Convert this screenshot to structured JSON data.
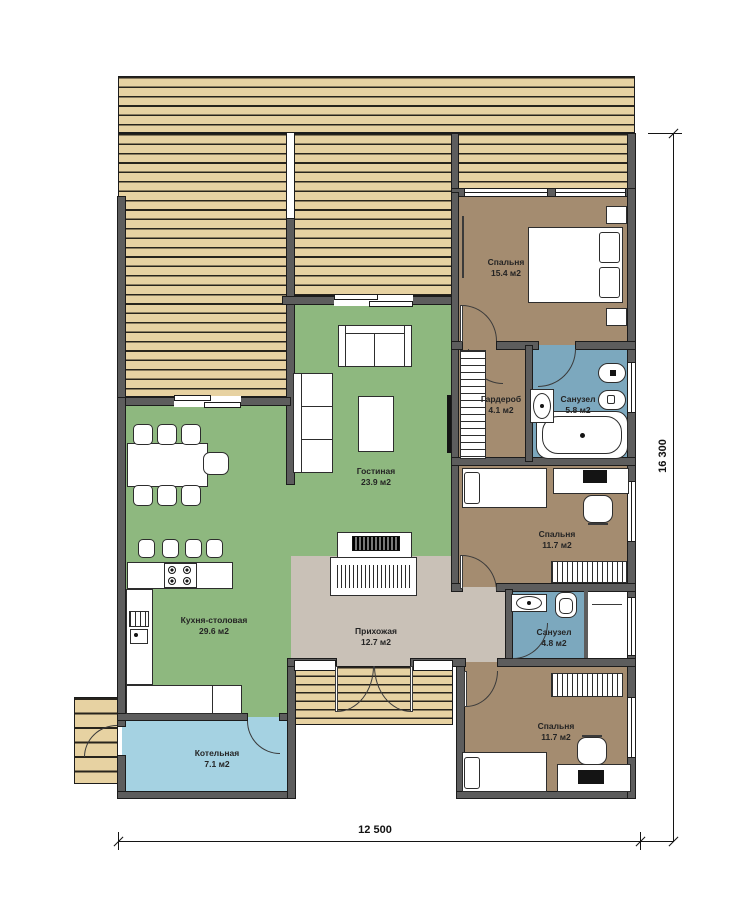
{
  "document": {
    "type": "floor-plan",
    "floor": "1"
  },
  "rooms": [
    {
      "id": "bedroom-1",
      "name": "Спальня",
      "area": "15.4 м2"
    },
    {
      "id": "wardrobe",
      "name": "Гардероб",
      "area": "4.1 м2"
    },
    {
      "id": "bathroom-1",
      "name": "Санузел",
      "area": "5.8 м2"
    },
    {
      "id": "bedroom-2",
      "name": "Спальня",
      "area": "11.7 м2"
    },
    {
      "id": "bathroom-2",
      "name": "Санузел",
      "area": "4.8 м2"
    },
    {
      "id": "bedroom-3",
      "name": "Спальня",
      "area": "11.7 м2"
    },
    {
      "id": "living-room",
      "name": "Гостиная",
      "area": "23.9 м2"
    },
    {
      "id": "kitchen-dining",
      "name": "Кухня-столовая",
      "area": "29.6 м2"
    },
    {
      "id": "hallway",
      "name": "Прихожая",
      "area": "12.7 м2"
    },
    {
      "id": "boiler-room",
      "name": "Котельная",
      "area": "7.1 м2"
    }
  ],
  "dimensions": {
    "width_mm": "12 500",
    "height_mm": "16 300"
  },
  "colors": {
    "deck_wood": "#e7d2a2",
    "wall": "#5d5d5d",
    "living_kitchen_floor": "#8eb87f",
    "bedroom_floor": "#a48c70",
    "bathroom_floor": "#7ca8be",
    "hallway_floor": "#c9c1b7",
    "boiler_floor": "#a5d2e2"
  }
}
